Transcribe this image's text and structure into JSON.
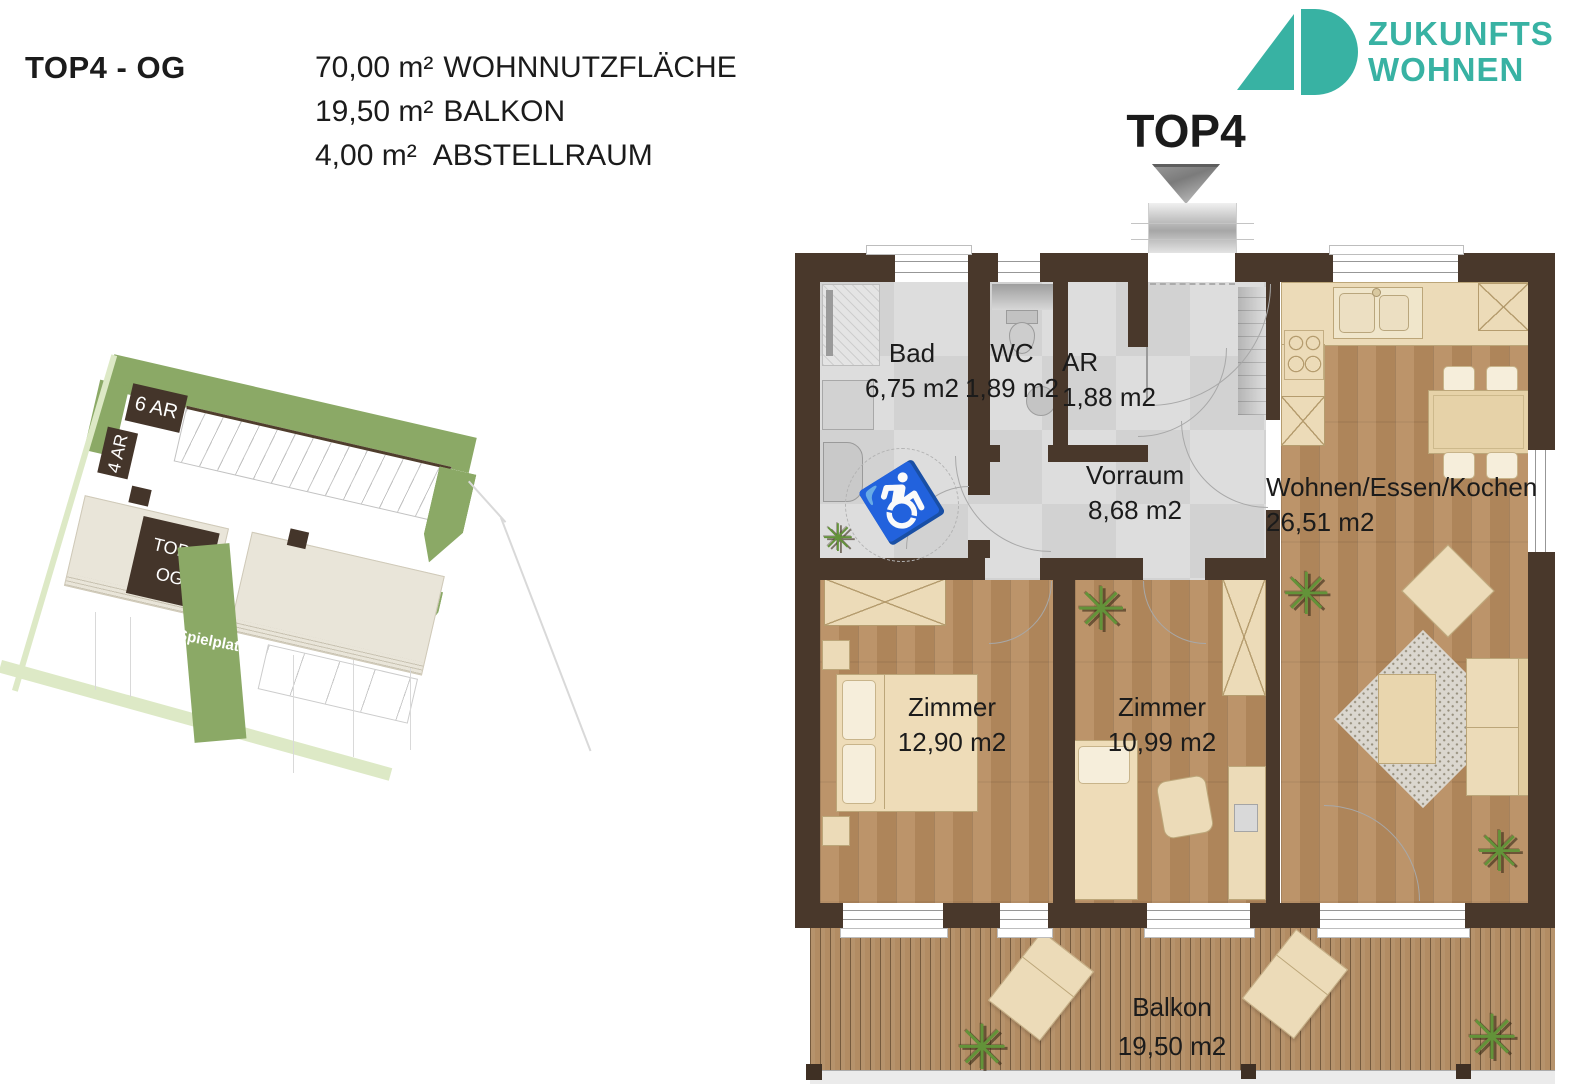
{
  "header": {
    "title": "TOP4 - OG",
    "areas": [
      {
        "value": "70,00 m²",
        "label": "WOHNNUTZFLÄCHE"
      },
      {
        "value": "19,50 m²",
        "label": "BALKON"
      },
      {
        "value": "4,00 m²",
        "label": "ABSTELLRAUM"
      }
    ]
  },
  "logo": {
    "line1": "ZUKUNFTS",
    "line2": "WOHNEN"
  },
  "floorplan": {
    "unit_label": "TOP4",
    "rooms": [
      {
        "name": "Bad",
        "area": "6,75 m2"
      },
      {
        "name": "WC",
        "area": "1,89 m2"
      },
      {
        "name": "AR",
        "area": "1,88 m2"
      },
      {
        "name": "Vorraum",
        "area": "8,68 m2"
      },
      {
        "name": "Wohnen/Essen/Kochen",
        "area": "26,51 m2"
      },
      {
        "name": "Zimmer",
        "area": "12,90 m2"
      },
      {
        "name": "Zimmer",
        "area": "10,99 m2"
      },
      {
        "name": "Balkon",
        "area": "19,50 m2"
      }
    ]
  },
  "siteplan": {
    "ar6": "6 AR",
    "ar4": "4 AR",
    "unit_block": {
      "line1": "TOP4",
      "line2": "OG"
    },
    "spielplatz": "Spielplatz"
  },
  "icons": {
    "plant": "✳",
    "wheelchair": "♿"
  },
  "colors": {
    "accent_teal": "#38b2a3",
    "wall_brown": "#49382b",
    "site_green": "#8ba966",
    "site_green_light": "#dde9c6",
    "site_dark_brown": "#44352a",
    "floor_wood": "#b78c5f",
    "floor_tile": "#d6d6d6"
  }
}
